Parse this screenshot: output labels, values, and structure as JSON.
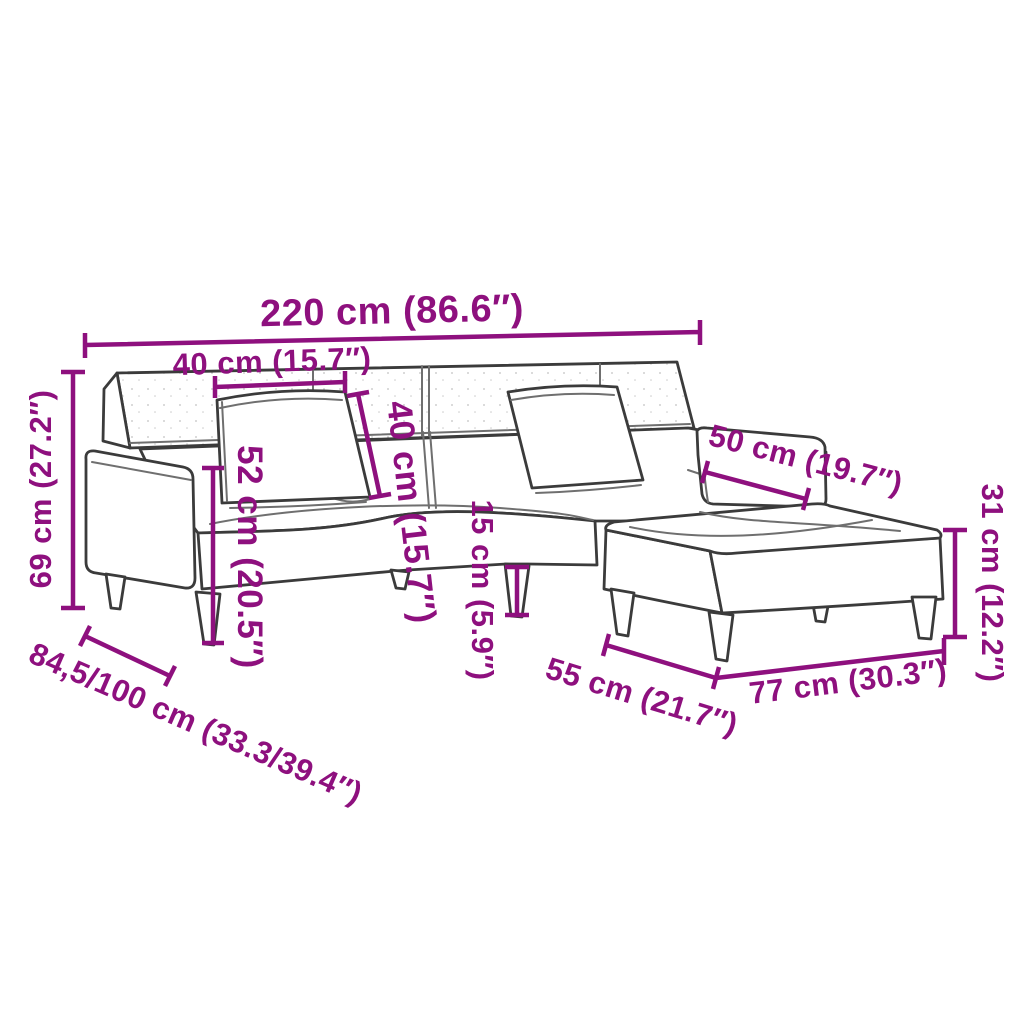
{
  "page": {
    "description": "Product dimension diagram of a 2-seater sofa bed with two cushions and a footstool, line drawing with magenta measurement annotations",
    "background": "#ffffff"
  },
  "colors": {
    "dimension": "#8E107E",
    "outline": "#3b3b3b",
    "seam": "#6f6f6f",
    "background": "#ffffff"
  },
  "dims": {
    "sofa_width": {
      "label": "220 cm (86.6″)",
      "cm": "220",
      "inches": "86.6"
    },
    "cushion_width": {
      "label": "40 cm (15.7″)",
      "cm": "40",
      "inches": "15.7"
    },
    "cushion_height": {
      "label": "40 cm (15.7″)",
      "cm": "40",
      "inches": "15.7"
    },
    "seat_height": {
      "label": "52 cm (20.5″)",
      "cm": "52",
      "inches": "20.5"
    },
    "backrest_height": {
      "label": "69 cm (27.2″)",
      "cm": "69",
      "inches": "27.2"
    },
    "leg_height": {
      "label": "15 cm (5.9″)",
      "cm": "15",
      "inches": "5.9"
    },
    "armrest_width": {
      "label": "50 cm (19.7″)",
      "cm": "50",
      "inches": "19.7"
    },
    "footstool_height": {
      "label": "31 cm (12.2″)",
      "cm": "31",
      "inches": "12.2"
    },
    "sofa_depth": {
      "label": "84,5/100 cm (33.3/39.4″)",
      "cm": "84,5/100",
      "inches": "33.3/39.4"
    },
    "footstool_depth": {
      "label": "55 cm (21.7″)",
      "cm": "55",
      "inches": "21.7"
    },
    "footstool_width": {
      "label": "77 cm (30.3″)",
      "cm": "77",
      "inches": "30.3"
    }
  }
}
